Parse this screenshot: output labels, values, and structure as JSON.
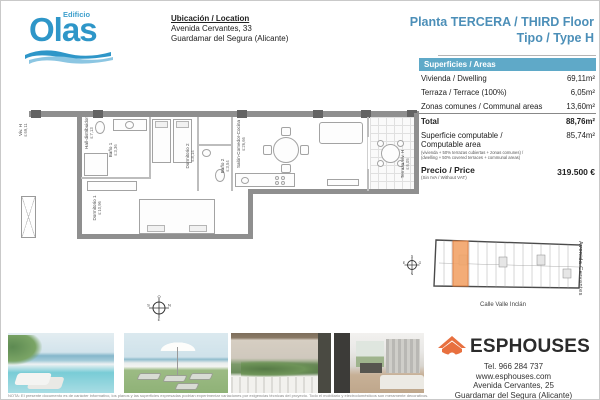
{
  "logo": {
    "edificio": "Edificio",
    "olas": "Olas",
    "blue": "#2e96c8"
  },
  "location": {
    "title": "Ubicación / Location",
    "line1": "Avenida Cervantes, 33",
    "line2": "Guardamar del Segura (Alicante)"
  },
  "heading": {
    "line1": "Planta TERCERA / THIRD Floor",
    "line2": "Tipo / Type H",
    "color": "#4c8fb8"
  },
  "areas_table": {
    "header": "Superficies / Areas",
    "header_bg": "#5fa9c8",
    "rows": [
      {
        "label": "Vivienda / Dwelling",
        "value": "69,11m²"
      },
      {
        "label": "Terraza / Terrace (100%)",
        "value": "6,05m²"
      },
      {
        "label": "Zonas comunes / Communal areas",
        "value": "13,60m²"
      }
    ],
    "total": {
      "label": "Total",
      "value": "88,76m²"
    },
    "computable": {
      "label1": "Superficie computable /",
      "label2": "Computable area",
      "note1": "(vivienda + 50% terrazas cubiertas + zonas comunes) /",
      "note2": "(dwelling + 50% covered terraces + communal areas)",
      "value": "85,74m²"
    },
    "price": {
      "label": "Precio / Price",
      "note": "(Sin IVA / Without VAT)",
      "value": "319.500 €"
    }
  },
  "floorplan": {
    "unit": {
      "name": "Viv. H",
      "area": "s:69,11"
    },
    "rooms": [
      {
        "name": "Hall-distribuidor",
        "area": "s:7,13"
      },
      {
        "name": "Baño 1",
        "area": "s:3,36"
      },
      {
        "name": "Dormitorio 1",
        "area": "s:10,96"
      },
      {
        "name": "Dormitorio 2",
        "area": "s:8,14"
      },
      {
        "name": "Baño 2",
        "area": "s:3,54"
      },
      {
        "name": "Salón-Comedor-Cocina",
        "area": "s:26,66"
      },
      {
        "name": "Terraza Viv. H",
        "area": "s:6,05"
      }
    ]
  },
  "compass_plan": {
    "top": "O",
    "right": "N",
    "bottom": "E",
    "left": "S"
  },
  "compass_key": {
    "top": "S",
    "right": "O",
    "bottom": "N",
    "left": "E"
  },
  "sitemap": {
    "street_bottom": "Calle Valle Inclán",
    "street_right": "Avenida Cervantes",
    "highlight_color": "#f2a469"
  },
  "photos": [
    {
      "name": "pool-sea-view"
    },
    {
      "name": "rooftop-terrace-loungers"
    },
    {
      "name": "balcony-plants"
    },
    {
      "name": "interior-living-room"
    }
  ],
  "agency": {
    "name": "ESPHOUSES",
    "accent": "#e8703f",
    "tel": "Tel. 966 284 737",
    "web": "www.esphouses.com",
    "address1": "Avenida Cervantes, 25",
    "address2": "Guardamar del Segura (Alicante)"
  },
  "disclaimer": "NOTA: El presente documento es de carácter informativo, los planos y las superficies expresadas podrían experimentar variaciones por exigencias técnicas del proyecto. Todo el mobiliario y electrodomésticos son meramente decorativos."
}
